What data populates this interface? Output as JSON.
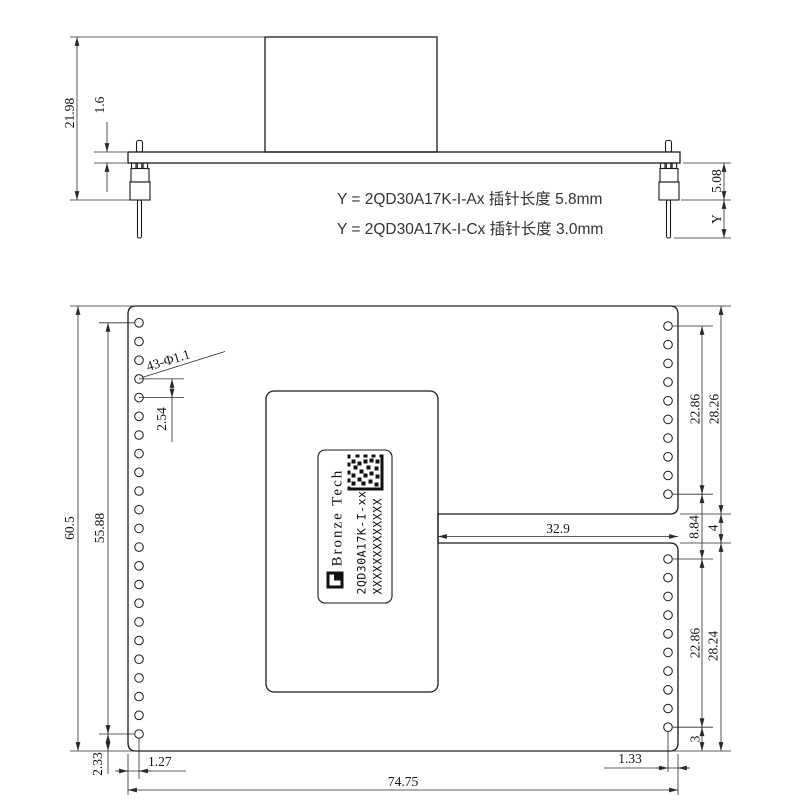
{
  "drawing": {
    "side_view": {
      "total_height": "21.98",
      "board_thickness": "1.6",
      "housing_height": "5.08",
      "pin_var": "Y",
      "note_ax": "Y = 2QD30A17K-I-Ax 插针长度 5.8mm",
      "note_cx": "Y = 2QD30A17K-I-Cx 插针长度 3.0mm"
    },
    "plan_view": {
      "overall_height": "60.5",
      "left_hole_span": "55.88",
      "left_bottom_offset": "2.33",
      "hole_pitch": "2.54",
      "hole_callout": "43-Φ1.1",
      "right_top_span": "22.86",
      "right_top_height": "28.26",
      "right_mid_gap": "8.84",
      "slot_height": "4",
      "right_bottom_span": "22.86",
      "right_bottom_height": "28.24",
      "right_bottom_offset": "3",
      "slot_length": "32.9",
      "left_edge_offset": "1.27",
      "right_edge_offset": "1.33",
      "overall_width": "74.75",
      "label": {
        "brand": "Bronze Tech",
        "model": "2QD30A17K-I-xx",
        "serial": "XXXXXXXXXXXXX"
      }
    }
  }
}
